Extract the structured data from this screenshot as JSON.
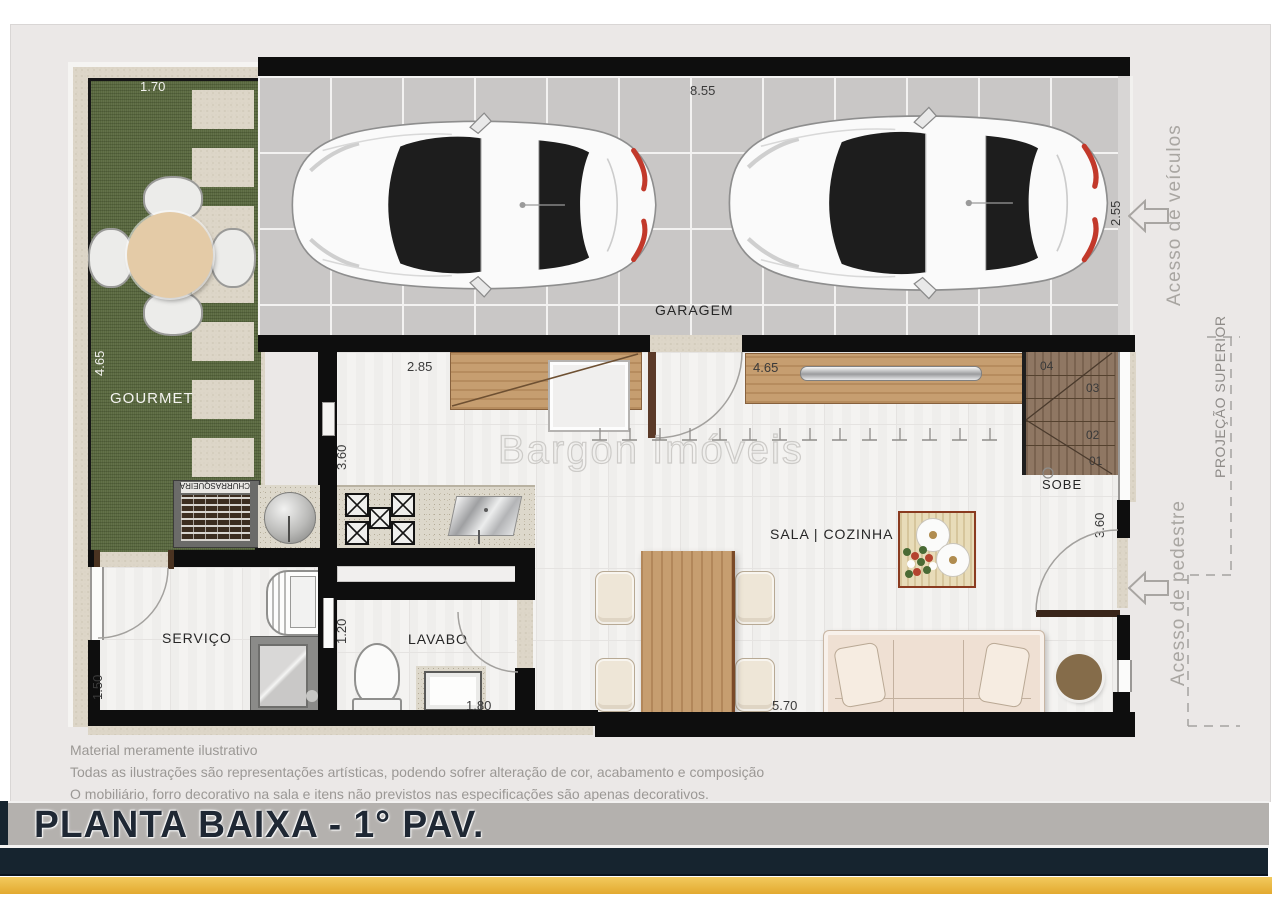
{
  "watermark": "Bargon Imóveis",
  "title": "PLANTA BAIXA - 1° PAV.",
  "disclaimer": {
    "line1": "Material meramente ilustrativo",
    "line2": "Todas as ilustrações são representações artísticas, podendo sofrer alteração de cor, acabamento e composição",
    "line3": "O mobiliário, forro decorativo na sala e itens não previstos nas especificações são apenas decorativos."
  },
  "rooms": {
    "garagem": "GARAGEM",
    "gourmet": "GOURMET",
    "churrasqueira": "CHURRASQUEIRA",
    "sala_cozinha": "SALA | COZINHA",
    "servico": "SERVIÇO",
    "lavabo": "LAVABO",
    "sobe": "SOBE"
  },
  "stairs_steps": [
    "04",
    "03",
    "02",
    "01"
  ],
  "dimensions": {
    "garage_width": "8.55",
    "garage_depth": "2.55",
    "gourmet_width": "1.70",
    "gourmet_height": "4.65",
    "kitchen_width": "2.85",
    "kitchen_height": "3.60",
    "sideboard_width": "4.65",
    "stairs_height": "3.60",
    "servico_height": "1.50",
    "servico_width": "2.30",
    "lavabo_height": "1.20",
    "lavabo_width": "1.80",
    "sala_width": "5.70"
  },
  "annotations": {
    "vehicle_access": "Acesso de veículos",
    "pedestrian_access": "Acesso de pedestre",
    "upper_projection": "PROJEÇÃO SUPERIOR"
  },
  "colors": {
    "accent_gold": "#e7b43c",
    "navy_band": "#16242f",
    "title_bar_gray": "#b4b1ae",
    "grass_green": "#59683f",
    "wall_black": "#0e0e0e"
  }
}
